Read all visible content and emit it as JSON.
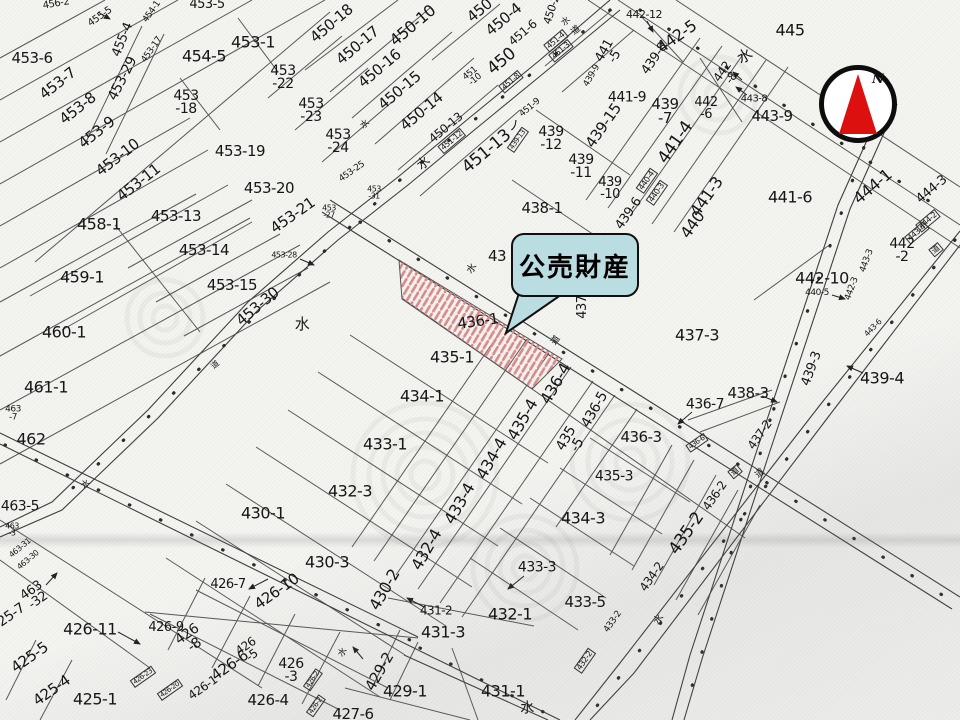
{
  "meta": {
    "type": "japanese-cadastral-parcel-map"
  },
  "colors": {
    "paper": "#f4f4f1",
    "boundary_line": "#4a4a4a",
    "hatch_red": "#d98b8b",
    "callout_fill": "#b9dde1",
    "callout_border": "#101010",
    "compass_red": "#dd1010"
  },
  "callout": {
    "text": "公売財産"
  },
  "compass": {
    "north_label": "N"
  },
  "highlight": {
    "parcel": "436-1",
    "style": "red-diagonal-hatch"
  },
  "labels": [
    {
      "t": "456-2",
      "x": 56,
      "y": 4,
      "r": -10,
      "s": 10
    },
    {
      "t": "455-5",
      "x": 100,
      "y": 17,
      "r": -35,
      "s": 10
    },
    {
      "t": "455-4",
      "x": 123,
      "y": 40,
      "r": -68,
      "s": 13
    },
    {
      "t": "454-1",
      "x": 152,
      "y": 12,
      "r": -55,
      "s": 9
    },
    {
      "t": "453-17",
      "x": 152,
      "y": 50,
      "r": -55,
      "s": 9
    },
    {
      "t": "453-5",
      "x": 207,
      "y": 5,
      "r": 0,
      "s": 13
    },
    {
      "t": "453-6",
      "x": 32,
      "y": 59,
      "r": 0,
      "s": 15
    },
    {
      "t": "453-7",
      "x": 58,
      "y": 84,
      "r": -38,
      "s": 15
    },
    {
      "t": "453-8",
      "x": 78,
      "y": 109,
      "r": -38,
      "s": 15
    },
    {
      "t": "453-9",
      "x": 97,
      "y": 133,
      "r": -38,
      "s": 15
    },
    {
      "t": "453-10",
      "x": 118,
      "y": 158,
      "r": -38,
      "s": 15
    },
    {
      "t": "453-11",
      "x": 139,
      "y": 183,
      "r": -38,
      "s": 15
    },
    {
      "t": "453-29",
      "x": 123,
      "y": 79,
      "r": -63,
      "s": 14
    },
    {
      "t": "454-5",
      "x": 204,
      "y": 57,
      "r": 0,
      "s": 16
    },
    {
      "t": "453-1",
      "x": 253,
      "y": 43,
      "r": 0,
      "s": 16
    },
    {
      "t": "453\n-18",
      "x": 186,
      "y": 103,
      "r": 0,
      "s": 14
    },
    {
      "t": "453\n-22",
      "x": 283,
      "y": 78,
      "r": 0,
      "s": 14
    },
    {
      "t": "453\n-23",
      "x": 311,
      "y": 111,
      "r": 0,
      "s": 14
    },
    {
      "t": "453\n-24",
      "x": 338,
      "y": 142,
      "r": 0,
      "s": 14
    },
    {
      "t": "453-25",
      "x": 352,
      "y": 172,
      "r": -35,
      "s": 9
    },
    {
      "t": "453-19",
      "x": 240,
      "y": 152,
      "r": 0,
      "s": 15
    },
    {
      "t": "453-20",
      "x": 269,
      "y": 189,
      "r": 0,
      "s": 15
    },
    {
      "t": "453-21",
      "x": 293,
      "y": 216,
      "r": -35,
      "s": 15
    },
    {
      "t": "453\n-31",
      "x": 374,
      "y": 193,
      "r": 0,
      "s": 8
    },
    {
      "t": "453\n-27",
      "x": 329,
      "y": 212,
      "r": 0,
      "s": 8
    },
    {
      "t": "458-1",
      "x": 99,
      "y": 225,
      "r": 0,
      "s": 16
    },
    {
      "t": "453-13",
      "x": 176,
      "y": 217,
      "r": 0,
      "s": 15
    },
    {
      "t": "453-14",
      "x": 204,
      "y": 251,
      "r": 0,
      "s": 15
    },
    {
      "t": "453-15",
      "x": 232,
      "y": 286,
      "r": 0,
      "s": 15
    },
    {
      "t": "453-28",
      "x": 284,
      "y": 255,
      "r": 0,
      "s": 8
    },
    {
      "t": "453-30",
      "x": 258,
      "y": 307,
      "r": -40,
      "s": 15
    },
    {
      "t": "459-1",
      "x": 82,
      "y": 278,
      "r": 0,
      "s": 16
    },
    {
      "t": "460-1",
      "x": 64,
      "y": 333,
      "r": 0,
      "s": 16
    },
    {
      "t": "461-1",
      "x": 46,
      "y": 388,
      "r": 0,
      "s": 16
    },
    {
      "t": "463\n-7",
      "x": 13,
      "y": 414,
      "r": 0,
      "s": 9
    },
    {
      "t": "462",
      "x": 31,
      "y": 440,
      "r": 0,
      "s": 16
    },
    {
      "t": "463-5",
      "x": 20,
      "y": 507,
      "r": 0,
      "s": 14
    },
    {
      "t": "463\n-3",
      "x": 12,
      "y": 530,
      "r": 0,
      "s": 8
    },
    {
      "t": "463-31",
      "x": 20,
      "y": 548,
      "r": -40,
      "s": 8
    },
    {
      "t": "463-30",
      "x": 28,
      "y": 560,
      "r": -40,
      "s": 8
    },
    {
      "t": "463\n-32",
      "x": 35,
      "y": 596,
      "r": -35,
      "s": 13
    },
    {
      "t": "425-7",
      "x": 8,
      "y": 618,
      "r": -35,
      "s": 14
    },
    {
      "t": "425-5",
      "x": 30,
      "y": 658,
      "r": -35,
      "s": 15
    },
    {
      "t": "425-4",
      "x": 52,
      "y": 691,
      "r": -35,
      "s": 15
    },
    {
      "t": "425-1",
      "x": 95,
      "y": 700,
      "r": 0,
      "s": 16
    },
    {
      "t": "450-18",
      "x": 332,
      "y": 24,
      "r": -40,
      "s": 15
    },
    {
      "t": "450-17",
      "x": 358,
      "y": 46,
      "r": -40,
      "s": 15
    },
    {
      "t": "450-16",
      "x": 380,
      "y": 69,
      "r": -40,
      "s": 15
    },
    {
      "t": "450-15",
      "x": 400,
      "y": 91,
      "r": -40,
      "s": 15
    },
    {
      "t": "450-14",
      "x": 422,
      "y": 112,
      "r": -40,
      "s": 15
    },
    {
      "t": "450-13",
      "x": 446,
      "y": 128,
      "r": -40,
      "s": 12
    },
    {
      "t": "450-10",
      "x": 413,
      "y": 26,
      "r": -40,
      "s": 16
    },
    {
      "t": "450",
      "x": 480,
      "y": 11,
      "r": -40,
      "s": 15
    },
    {
      "t": "450-4",
      "x": 504,
      "y": 20,
      "r": -40,
      "s": 15
    },
    {
      "t": "451-6",
      "x": 523,
      "y": 33,
      "r": -40,
      "s": 12
    },
    {
      "t": "450",
      "x": 502,
      "y": 62,
      "r": -40,
      "s": 17
    },
    {
      "t": "450-2",
      "x": 552,
      "y": 10,
      "r": -72,
      "s": 11
    },
    {
      "t": "水",
      "x": 566,
      "y": 22,
      "r": -40,
      "s": 9
    },
    {
      "t": "道",
      "x": 576,
      "y": 31,
      "r": -40,
      "s": 9
    },
    {
      "t": "451-4",
      "x": 556,
      "y": 41,
      "r": -40,
      "s": 8,
      "b": true
    },
    {
      "t": "451-3",
      "x": 561,
      "y": 51,
      "r": -40,
      "s": 8,
      "b": true
    },
    {
      "t": "451\n-10",
      "x": 473,
      "y": 77,
      "r": -40,
      "s": 9
    },
    {
      "t": "451-8",
      "x": 511,
      "y": 82,
      "r": -40,
      "s": 8,
      "b": true
    },
    {
      "t": "451-9",
      "x": 530,
      "y": 108,
      "r": -40,
      "s": 9
    },
    {
      "t": "451-12",
      "x": 452,
      "y": 141,
      "r": -40,
      "s": 8,
      "b": true
    },
    {
      "t": "451-13",
      "x": 487,
      "y": 152,
      "r": -40,
      "s": 17
    },
    {
      "t": "ノ",
      "x": 514,
      "y": 126,
      "r": -15,
      "s": 12
    },
    {
      "t": "水",
      "x": 424,
      "y": 164,
      "r": -40,
      "s": 13
    },
    {
      "t": "439-13",
      "x": 518,
      "y": 140,
      "r": -55,
      "s": 7,
      "b": true
    },
    {
      "t": "441\n-5",
      "x": 610,
      "y": 54,
      "r": -60,
      "s": 13
    },
    {
      "t": "439-9",
      "x": 592,
      "y": 76,
      "r": -60,
      "s": 9
    },
    {
      "t": "439-8",
      "x": 655,
      "y": 59,
      "r": -55,
      "s": 13
    },
    {
      "t": "441-9",
      "x": 627,
      "y": 98,
      "r": 0,
      "s": 14
    },
    {
      "t": "439\n-7",
      "x": 665,
      "y": 112,
      "r": 0,
      "s": 15
    },
    {
      "t": "442-12",
      "x": 644,
      "y": 15,
      "r": 0,
      "s": 11
    },
    {
      "t": "442-5",
      "x": 677,
      "y": 37,
      "r": -35,
      "s": 16
    },
    {
      "t": "445",
      "x": 790,
      "y": 31,
      "r": 0,
      "s": 16
    },
    {
      "t": "水",
      "x": 745,
      "y": 57,
      "r": -30,
      "s": 15
    },
    {
      "t": "442\n-8",
      "x": 727,
      "y": 75,
      "r": -55,
      "s": 12
    },
    {
      "t": "443-8",
      "x": 754,
      "y": 99,
      "r": 0,
      "s": 10
    },
    {
      "t": "443-9",
      "x": 772,
      "y": 117,
      "r": 0,
      "s": 15
    },
    {
      "t": "442\n-6",
      "x": 706,
      "y": 109,
      "r": 0,
      "s": 13
    },
    {
      "t": "439-15",
      "x": 604,
      "y": 126,
      "r": -55,
      "s": 15
    },
    {
      "t": "439\n-12",
      "x": 551,
      "y": 139,
      "r": 0,
      "s": 14
    },
    {
      "t": "439\n-11",
      "x": 581,
      "y": 167,
      "r": 0,
      "s": 14
    },
    {
      "t": "439\n-10",
      "x": 610,
      "y": 189,
      "r": 0,
      "s": 13
    },
    {
      "t": "439-6",
      "x": 629,
      "y": 214,
      "r": -55,
      "s": 13
    },
    {
      "t": "441-4",
      "x": 676,
      "y": 143,
      "r": -55,
      "s": 17
    },
    {
      "t": "440-4",
      "x": 647,
      "y": 181,
      "r": -55,
      "s": 8,
      "b": true
    },
    {
      "t": "440-3",
      "x": 657,
      "y": 193,
      "r": -55,
      "s": 8,
      "b": true
    },
    {
      "t": "441-3",
      "x": 707,
      "y": 197,
      "r": -55,
      "s": 16
    },
    {
      "t": "440",
      "x": 693,
      "y": 225,
      "r": -55,
      "s": 16
    },
    {
      "t": "441-6",
      "x": 790,
      "y": 198,
      "r": 0,
      "s": 16
    },
    {
      "t": "444-1",
      "x": 873,
      "y": 187,
      "r": -40,
      "s": 16
    },
    {
      "t": "444-3",
      "x": 932,
      "y": 190,
      "r": -40,
      "s": 13
    },
    {
      "t": "444-2",
      "x": 928,
      "y": 221,
      "r": -40,
      "s": 8,
      "b": true
    },
    {
      "t": "443-4",
      "x": 917,
      "y": 233,
      "r": -40,
      "s": 8,
      "b": true
    },
    {
      "t": "道",
      "x": 936,
      "y": 250,
      "r": -40,
      "s": 8,
      "b": true
    },
    {
      "t": "442\n-2",
      "x": 902,
      "y": 251,
      "r": 0,
      "s": 14
    },
    {
      "t": "442-10",
      "x": 822,
      "y": 279,
      "r": 0,
      "s": 16
    },
    {
      "t": "440-5",
      "x": 817,
      "y": 293,
      "r": 0,
      "s": 9
    },
    {
      "t": "443-3",
      "x": 867,
      "y": 261,
      "r": -70,
      "s": 9
    },
    {
      "t": "442-3",
      "x": 852,
      "y": 289,
      "r": -70,
      "s": 9
    },
    {
      "t": "443-6",
      "x": 873,
      "y": 328,
      "r": -45,
      "s": 8
    },
    {
      "t": "439-3",
      "x": 812,
      "y": 369,
      "r": -70,
      "s": 13
    },
    {
      "t": "439-4",
      "x": 882,
      "y": 379,
      "r": 0,
      "s": 16
    },
    {
      "t": "438-3",
      "x": 748,
      "y": 394,
      "r": 0,
      "s": 15
    },
    {
      "t": "436-7",
      "x": 705,
      "y": 405,
      "r": 0,
      "s": 14
    },
    {
      "t": "437-3",
      "x": 697,
      "y": 336,
      "r": 0,
      "s": 16
    },
    {
      "t": "438-1",
      "x": 542,
      "y": 209,
      "r": 0,
      "s": 15
    },
    {
      "t": "43",
      "x": 497,
      "y": 257,
      "r": 0,
      "s": 15
    },
    {
      "t": "437-",
      "x": 583,
      "y": 305,
      "r": -90,
      "s": 13
    },
    {
      "t": "水",
      "x": 472,
      "y": 269,
      "r": -55,
      "s": 10
    },
    {
      "t": "道",
      "x": 556,
      "y": 341,
      "r": -55,
      "s": 9
    },
    {
      "t": "436-1",
      "x": 478,
      "y": 322,
      "r": -8,
      "s": 15
    },
    {
      "t": "435-1",
      "x": 452,
      "y": 358,
      "r": 0,
      "s": 16
    },
    {
      "t": "434-1",
      "x": 422,
      "y": 397,
      "r": 0,
      "s": 16
    },
    {
      "t": "433-1",
      "x": 385,
      "y": 445,
      "r": 0,
      "s": 16
    },
    {
      "t": "432-3",
      "x": 350,
      "y": 492,
      "r": 0,
      "s": 16
    },
    {
      "t": "430-1",
      "x": 263,
      "y": 514,
      "r": 0,
      "s": 16
    },
    {
      "t": "430-3",
      "x": 327,
      "y": 563,
      "r": 0,
      "s": 16
    },
    {
      "t": "430-2",
      "x": 385,
      "y": 590,
      "r": -60,
      "s": 16
    },
    {
      "t": "432-4",
      "x": 427,
      "y": 550,
      "r": -60,
      "s": 16
    },
    {
      "t": "433-4",
      "x": 460,
      "y": 504,
      "r": -60,
      "s": 16
    },
    {
      "t": "434-4",
      "x": 492,
      "y": 459,
      "r": -60,
      "s": 16
    },
    {
      "t": "435-4",
      "x": 523,
      "y": 420,
      "r": -60,
      "s": 16
    },
    {
      "t": "436-4",
      "x": 556,
      "y": 384,
      "r": -60,
      "s": 16
    },
    {
      "t": "435\n-5",
      "x": 572,
      "y": 442,
      "r": -60,
      "s": 14
    },
    {
      "t": "436-5",
      "x": 595,
      "y": 410,
      "r": -60,
      "s": 14
    },
    {
      "t": "436-3",
      "x": 641,
      "y": 438,
      "r": 0,
      "s": 15
    },
    {
      "t": "435-3",
      "x": 614,
      "y": 477,
      "r": 0,
      "s": 14
    },
    {
      "t": "434-3",
      "x": 583,
      "y": 519,
      "r": 0,
      "s": 16
    },
    {
      "t": "433-3",
      "x": 537,
      "y": 568,
      "r": 0,
      "s": 14
    },
    {
      "t": "433-5",
      "x": 585,
      "y": 603,
      "r": 0,
      "s": 15
    },
    {
      "t": "432-1",
      "x": 510,
      "y": 615,
      "r": 0,
      "s": 16
    },
    {
      "t": "431-2",
      "x": 436,
      "y": 611,
      "r": 0,
      "s": 12
    },
    {
      "t": "431-3",
      "x": 443,
      "y": 633,
      "r": 0,
      "s": 16
    },
    {
      "t": "429-2",
      "x": 380,
      "y": 672,
      "r": -60,
      "s": 15
    },
    {
      "t": "429-1",
      "x": 405,
      "y": 692,
      "r": 0,
      "s": 16
    },
    {
      "t": "431-1",
      "x": 503,
      "y": 692,
      "r": 0,
      "s": 16
    },
    {
      "t": "427-6",
      "x": 353,
      "y": 715,
      "r": 0,
      "s": 15
    },
    {
      "t": "水",
      "x": 527,
      "y": 709,
      "r": 0,
      "s": 14
    },
    {
      "t": "水",
      "x": 343,
      "y": 653,
      "r": -55,
      "s": 9
    },
    {
      "t": "426-2",
      "x": 313,
      "y": 680,
      "r": -55,
      "s": 7,
      "b": true
    },
    {
      "t": "426-2",
      "x": 316,
      "y": 706,
      "r": -55,
      "s": 7,
      "b": true
    },
    {
      "t": "432-2",
      "x": 585,
      "y": 661,
      "r": -55,
      "s": 8,
      "b": true
    },
    {
      "t": "433-2",
      "x": 613,
      "y": 622,
      "r": -55,
      "s": 9
    },
    {
      "t": "434-2",
      "x": 652,
      "y": 577,
      "r": -55,
      "s": 12
    },
    {
      "t": "435-2",
      "x": 687,
      "y": 534,
      "r": -55,
      "s": 17
    },
    {
      "t": "436-2",
      "x": 715,
      "y": 496,
      "r": -55,
      "s": 12
    },
    {
      "t": "437-2",
      "x": 760,
      "y": 435,
      "r": -55,
      "s": 12
    },
    {
      "t": "436-6",
      "x": 697,
      "y": 443,
      "r": -35,
      "s": 7,
      "b": true
    },
    {
      "t": "道",
      "x": 735,
      "y": 472,
      "r": -40,
      "s": 8,
      "b": true
    },
    {
      "t": "道",
      "x": 760,
      "y": 474,
      "r": -40,
      "s": 9
    },
    {
      "t": "水",
      "x": 659,
      "y": 620,
      "r": -55,
      "s": 10
    },
    {
      "t": "426-7",
      "x": 228,
      "y": 585,
      "r": 0,
      "s": 13
    },
    {
      "t": "426-10",
      "x": 277,
      "y": 592,
      "r": -35,
      "s": 15
    },
    {
      "t": "426\n-8",
      "x": 191,
      "y": 640,
      "r": -35,
      "s": 14
    },
    {
      "t": "426-9",
      "x": 166,
      "y": 628,
      "r": 0,
      "s": 13
    },
    {
      "t": "426-11",
      "x": 90,
      "y": 630,
      "r": 0,
      "s": 16
    },
    {
      "t": "426-6",
      "x": 230,
      "y": 666,
      "r": -35,
      "s": 15
    },
    {
      "t": "426\n-5",
      "x": 249,
      "y": 651,
      "r": -35,
      "s": 12
    },
    {
      "t": "426\n-3",
      "x": 291,
      "y": 671,
      "r": 0,
      "s": 14
    },
    {
      "t": "426-4",
      "x": 268,
      "y": 701,
      "r": 0,
      "s": 15
    },
    {
      "t": "426-1",
      "x": 203,
      "y": 688,
      "r": -35,
      "s": 12
    },
    {
      "t": "426-23",
      "x": 143,
      "y": 677,
      "r": -35,
      "s": 7,
      "b": true
    },
    {
      "t": "426-20",
      "x": 170,
      "y": 690,
      "r": -35,
      "s": 7,
      "b": true
    },
    {
      "t": "水",
      "x": 302,
      "y": 325,
      "r": 0,
      "s": 15
    },
    {
      "t": "道",
      "x": 215,
      "y": 365,
      "r": -40,
      "s": 8
    },
    {
      "t": "水",
      "x": 365,
      "y": 125,
      "r": -40,
      "s": 9
    },
    {
      "t": "水",
      "x": 86,
      "y": 485,
      "r": -40,
      "s": 9
    }
  ]
}
